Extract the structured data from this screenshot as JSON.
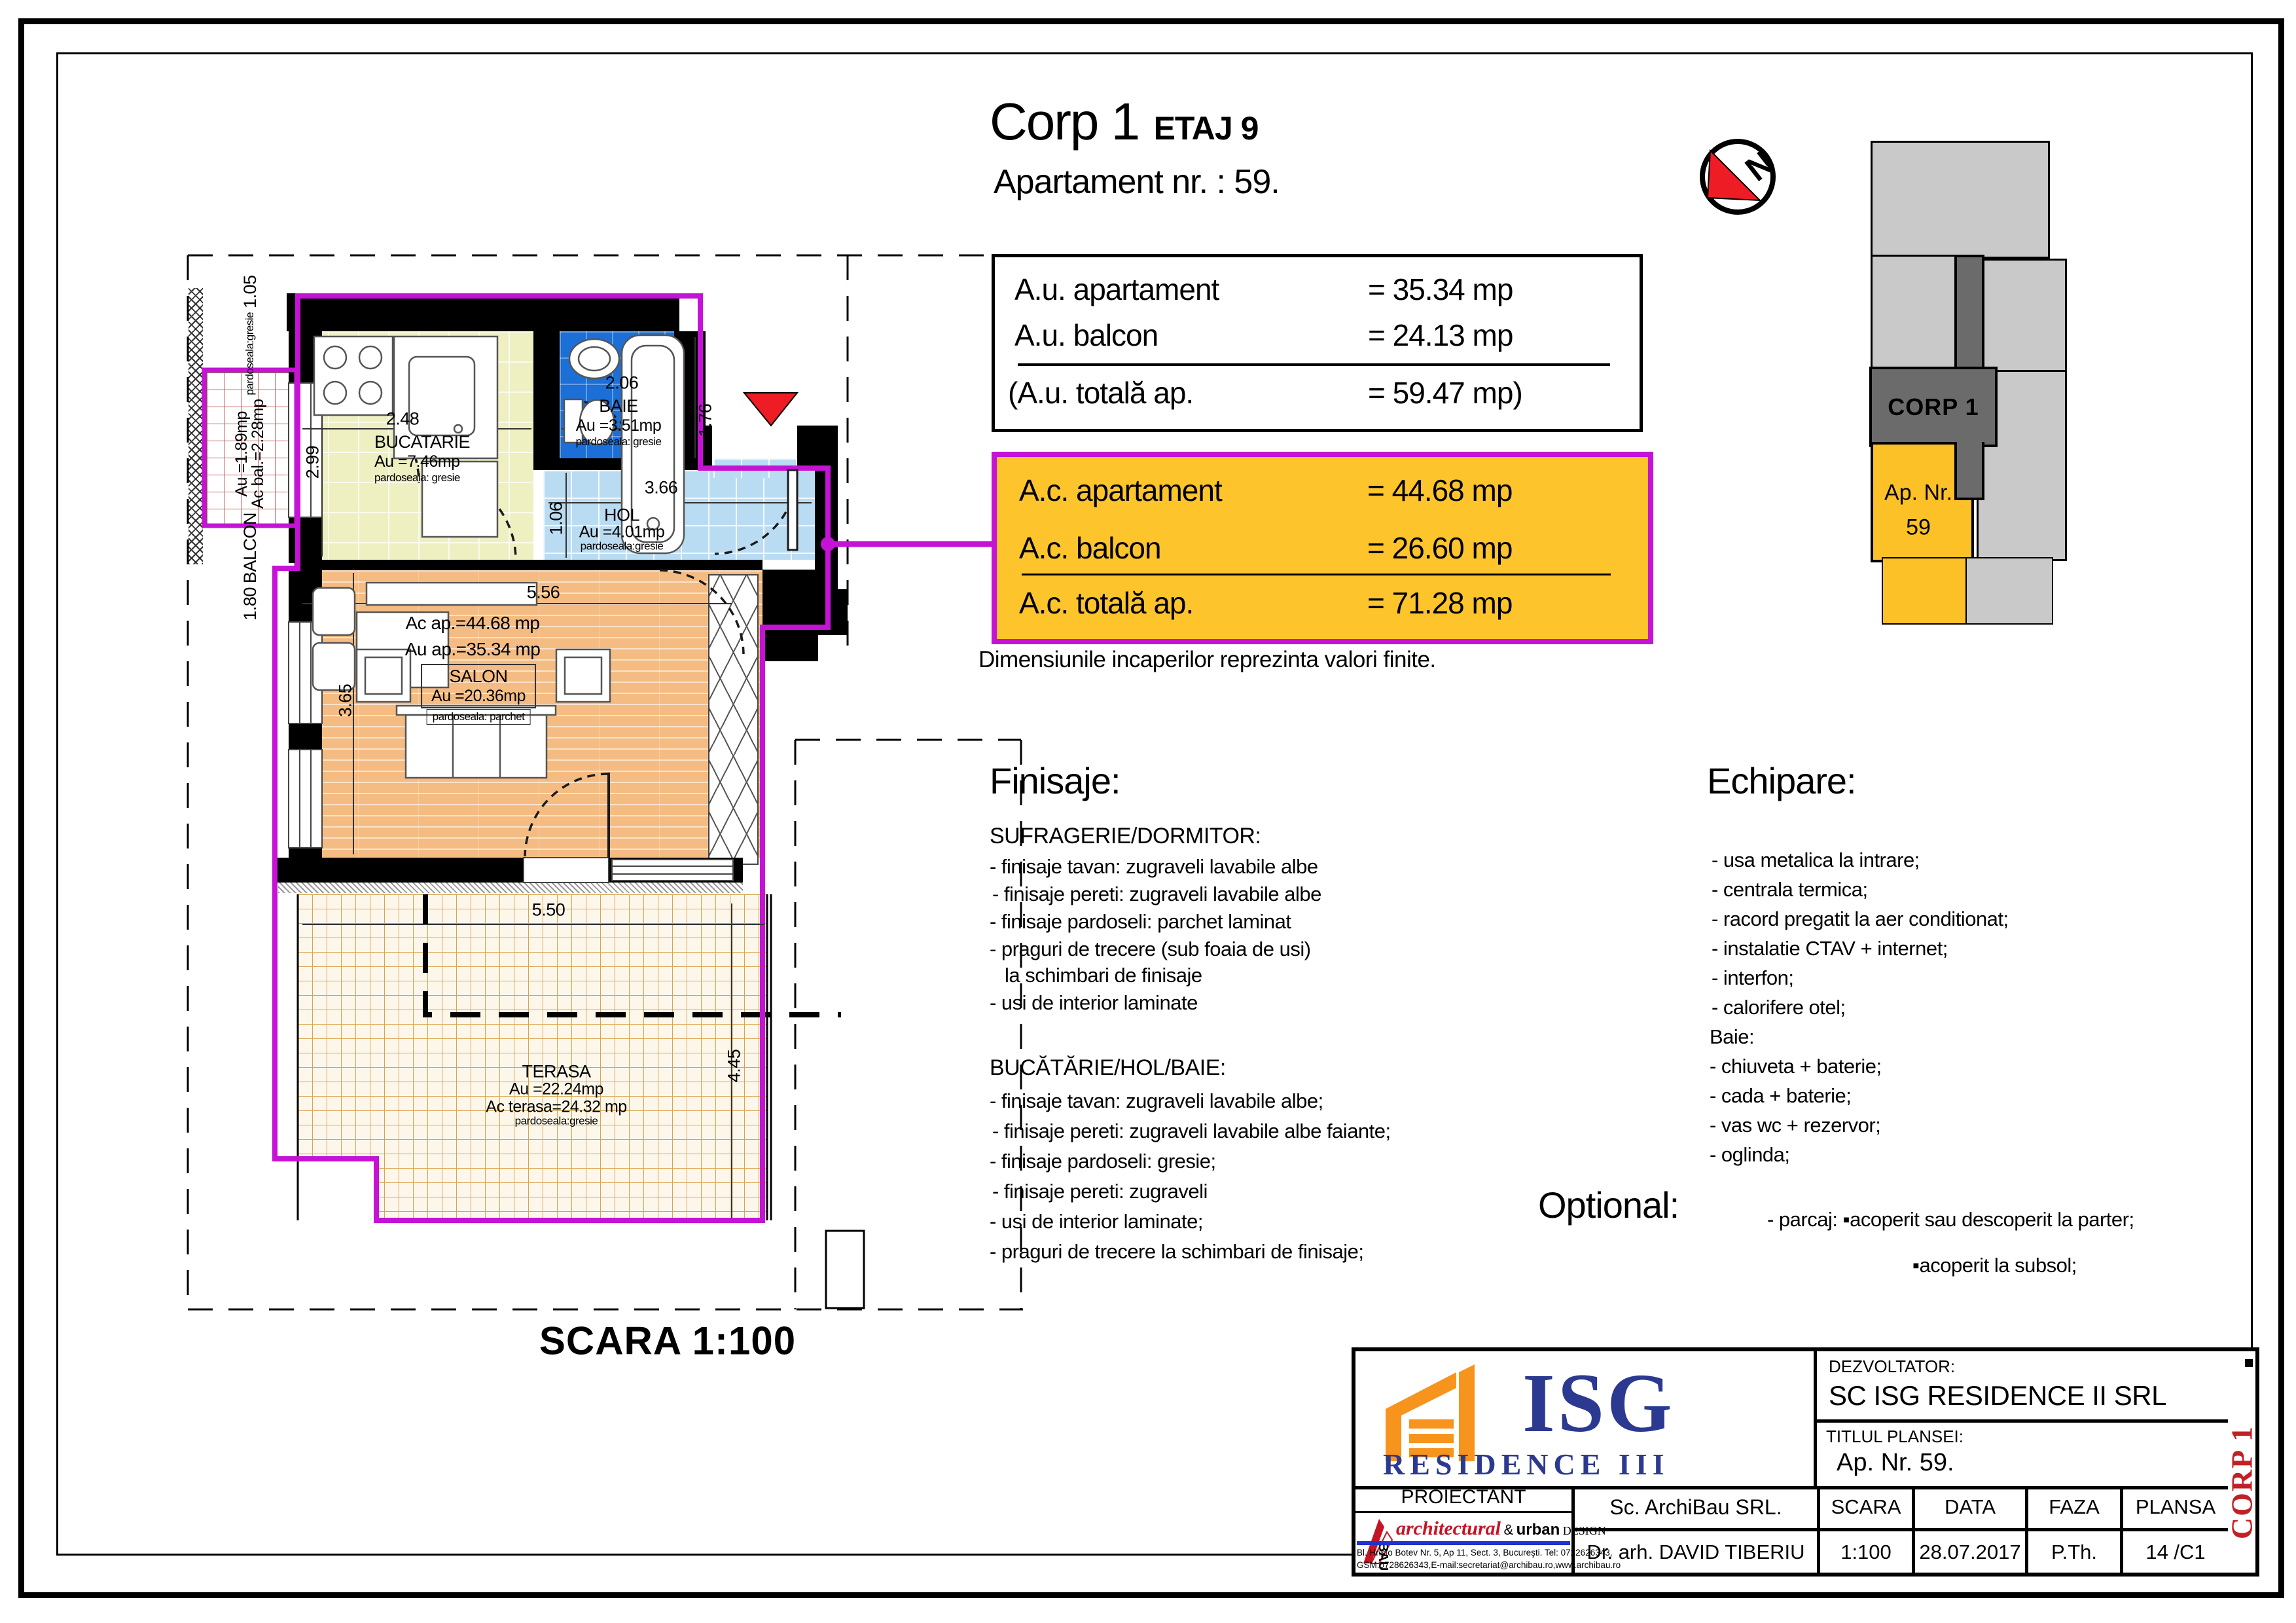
{
  "colors": {
    "magenta_contour": "#c513d6",
    "table_orange": "#fdc42c",
    "baie_blue": "#1b6fd6",
    "hol_blue": "#badcf2",
    "bucatarie_green": "#eef0c2",
    "salon_orange": "#f4bc82",
    "site_yellow": "#fcc127",
    "site_gray": "#c9c9c9",
    "site_dark_gray": "#6b6b6b",
    "isg_navy": "#2b3990",
    "logo_orange": "#f7941d",
    "entry_red": "#ee1c25",
    "corp_red": "#c22026"
  },
  "header": {
    "title": "Corp 1",
    "floor": "ETAJ 9",
    "subtitle": "Apartament nr. : 59."
  },
  "au_table": {
    "rows": [
      {
        "label": "A.u. apartament",
        "value": "= 35.34 mp"
      },
      {
        "label": "A.u. balcon",
        "value": "= 24.13 mp"
      }
    ],
    "total": {
      "label": "(A.u. totală ap.",
      "value": "= 59.47 mp)"
    }
  },
  "ac_table": {
    "rows": [
      {
        "label": "A.c. apartament",
        "value": "= 44.68 mp"
      },
      {
        "label": "A.c. balcon",
        "value": "= 26.60 mp"
      }
    ],
    "total": {
      "label": "A.c. totală ap.",
      "value": "= 71.28 mp"
    }
  },
  "note": "Dimensiunile incaperilor reprezinta valori finite.",
  "finisaje": {
    "heading": "Finisaje:",
    "sections": [
      {
        "title": "SUFRAGERIE/DORMITOR:",
        "items": [
          "- finisaje tavan: zugraveli lavabile albe",
          "- finisaje pereti: zugraveli lavabile albe",
          "- finisaje pardoseli: parchet laminat",
          "- praguri de trecere (sub foaia de usi)",
          "la schimbari de finisaje",
          "- usi de interior laminate"
        ]
      },
      {
        "title": "BUCĂTĂRIE/HOL/BAIE:",
        "items": [
          "- finisaje tavan: zugraveli lavabile albe;",
          "- finisaje pereti: zugraveli lavabile albe faiante;",
          "- finisaje pardoseli: gresie;",
          "- finisaje pereti: zugraveli",
          "- usi de interior laminate;",
          "- praguri de trecere la schimbari de finisaje;"
        ]
      }
    ]
  },
  "echipare": {
    "heading": "Echipare:",
    "items": [
      "- usa metalica la intrare;",
      "- centrala termica;",
      "- racord pregatit la aer  conditionat;",
      "- instalatie CTAV + internet;",
      "- interfon;",
      "- calorifere otel;",
      "Baie:",
      "- chiuveta + baterie;",
      "- cada + baterie;",
      "- vas wc + rezervor;",
      "- oglinda;"
    ]
  },
  "optional": {
    "heading": "Optional:",
    "line1": "- parcaj: ▪acoperit sau descoperit la parter;",
    "line2": "▪acoperit la subsol;"
  },
  "plan": {
    "scale_label": "SCARA 1:100",
    "north_letter": "N",
    "rooms": {
      "balcon": {
        "dim_top": "1.80",
        "name": "BALCON",
        "au": "Au =1.89mp",
        "ac": "Ac bal.=2.28mp",
        "floor": "pardoseala:gresie",
        "dim_bottom": "1.05"
      },
      "bucatarie": {
        "name": "BUCATARIE",
        "au": "Au =7.46mp",
        "floor": "pardoseala: gresie",
        "dim_w": "2.48",
        "dim_h": "2.99"
      },
      "baie": {
        "name": "BAIE",
        "au": "Au =3.51mp",
        "floor": "pardoseala: gresie",
        "dim_w": "2.06",
        "dim_h": "1.76"
      },
      "hol": {
        "name": "HOL",
        "au": "Au =4.01mp",
        "floor": "pardoseala:gresie",
        "dim_w": "3.66",
        "dim_h": "1.06"
      },
      "salon": {
        "name": "SALON",
        "au": "Au =20.36mp",
        "floor": "pardoseala: parchet",
        "dim_w": "5.56",
        "dim_h": "3.65",
        "ac_ap": "Ac ap.=44.68 mp",
        "au_ap": "Au ap.=35.34 mp"
      },
      "terasa": {
        "name": "TERASA",
        "au": "Au =22.24mp",
        "ac": "Ac terasa=24.32 mp",
        "floor": "pardoseala:gresie",
        "dim_w": "5.50",
        "dim_h": "4.45"
      }
    }
  },
  "site_plan": {
    "corp_label": "CORP 1",
    "ap_label_line1": "Ap. Nr.",
    "ap_label_line2": "59"
  },
  "title_block": {
    "logo": {
      "word": "ISG",
      "sub": "RESIDENCE III"
    },
    "dezvoltator_label": "DEZVOLTATOR:",
    "dezvoltator": "SC ISG RESIDENCE II SRL",
    "titlul_label": "TITLUL  PLANSEI:",
    "titlul": "Ap. Nr. 59.",
    "proiectant_label": "PROIECTANT",
    "archibau": {
      "script": "architectural",
      "amp": "&",
      "urban": "urban",
      "design": "DESIGN",
      "bau": "BAU",
      "address1": "Bl. Hristo Botev  Nr. 5, Ap 11, Sect. 3,  Bucureşti.  Tel: 0722626343,",
      "address2": "GSM:0728626343,E-mail:secretariat@archibau.ro,www.archibau.ro"
    },
    "company": "Sc. ArchiBau SRL.",
    "architect": "Dr. arh. DAVID TIBERIU",
    "scara_label": "SCARA",
    "scara": "1:100",
    "data_label": "DATA",
    "data": "28.07.2017",
    "faza_label": "FAZA",
    "faza": "P.Th.",
    "plansa_label": "PLANSA",
    "plansa": "14 /C1",
    "corp_vertical": "CORP 1"
  }
}
